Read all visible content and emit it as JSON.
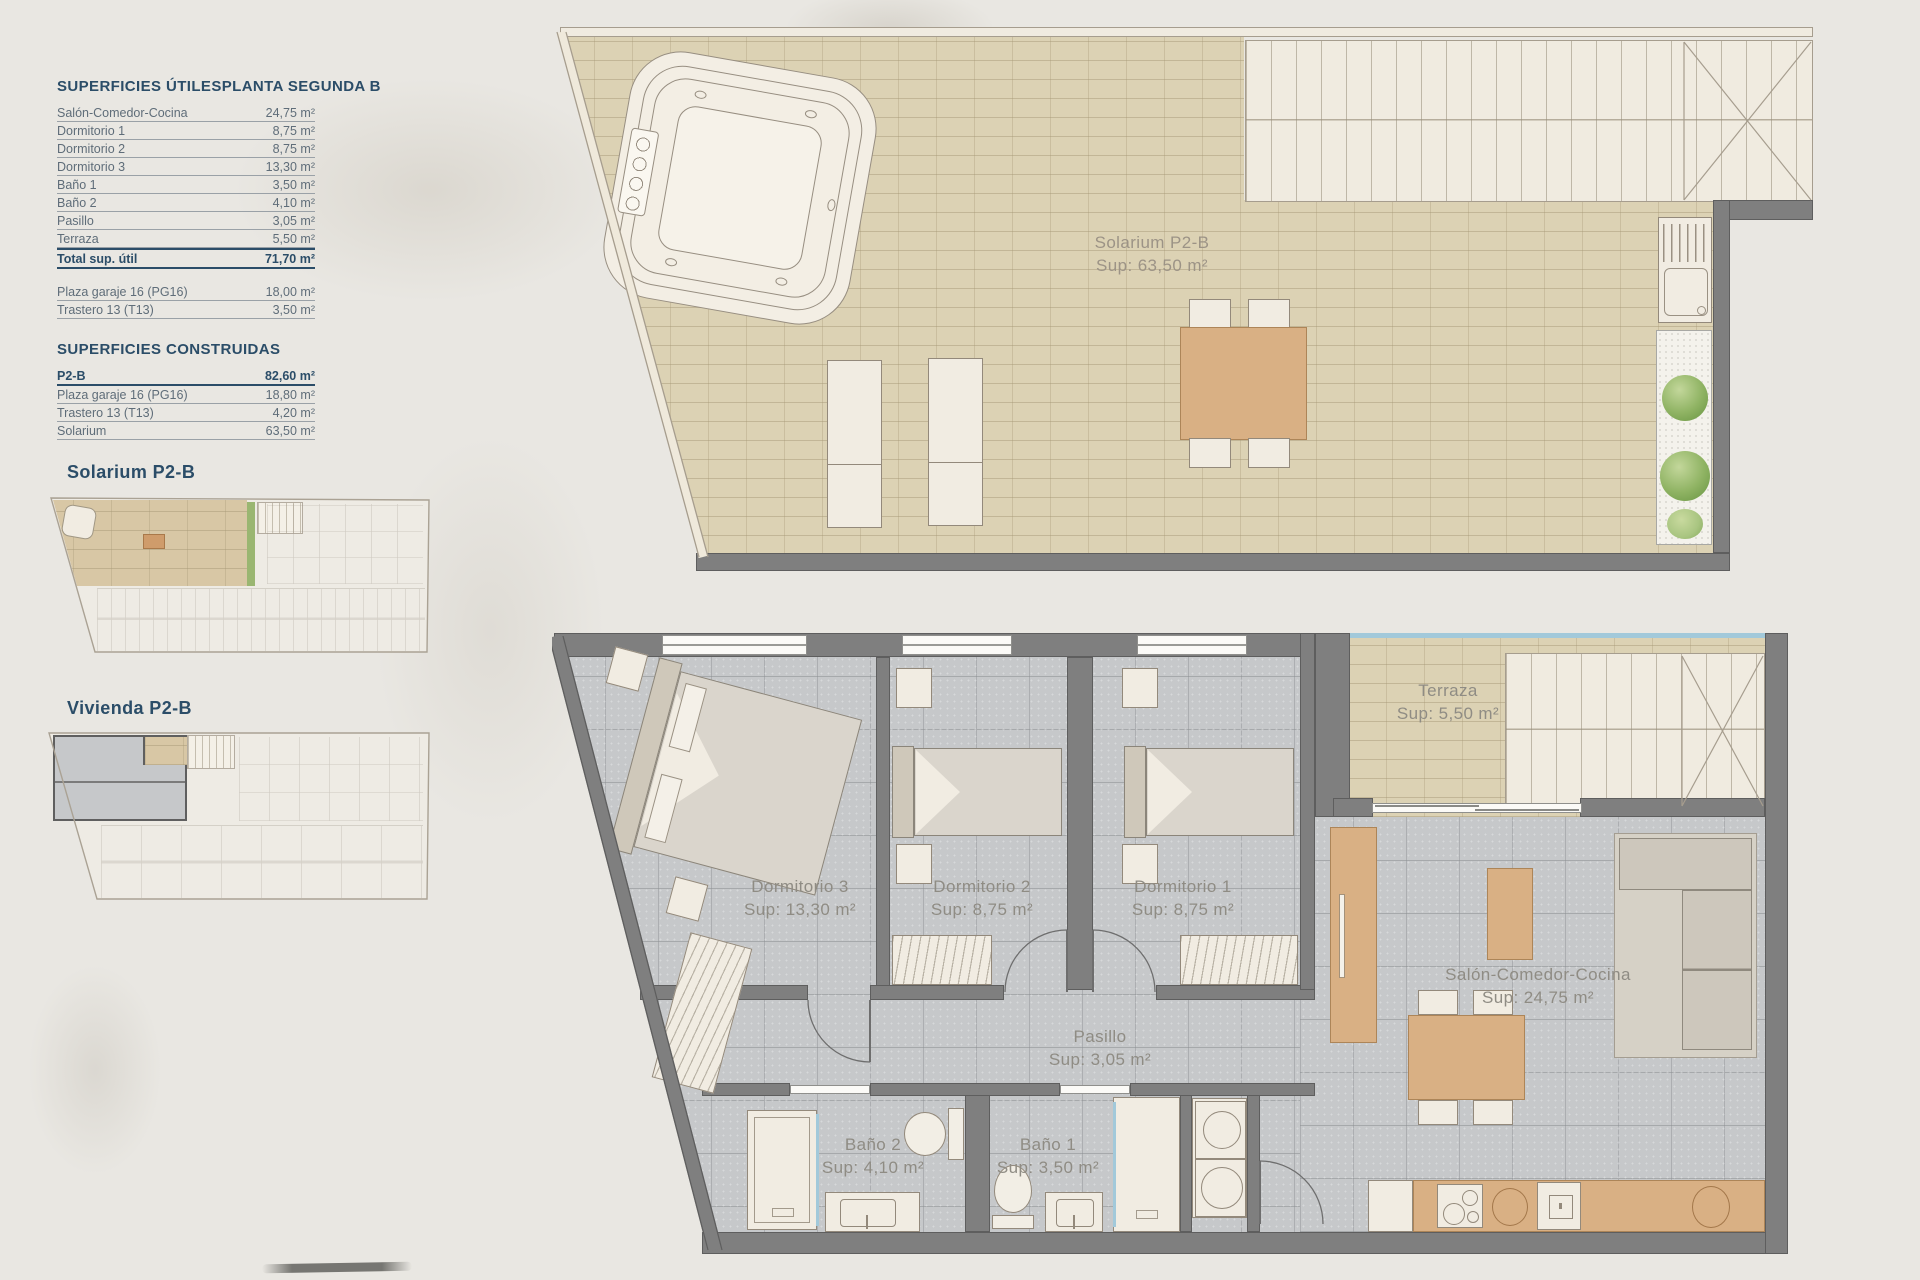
{
  "colors": {
    "heading_navy": "#2b4d68",
    "table_text": "#5f6d79",
    "plan_label_gray": "#8f8c84",
    "wall_gray": "#7f7f7f",
    "beige_tile": "#dcd2b4",
    "gray_tile": "#c6c8ca",
    "wood": "#d9b084",
    "glass_blue": "#a2c9da",
    "plant_green": "#8fb363",
    "highlight_tan": "#d8c7a5"
  },
  "left_panel": {
    "utiles": {
      "title": "SUPERFICIES ÚTILES",
      "subtitle": "PLANTA SEGUNDA B",
      "rows": [
        {
          "label": "Salón-Comedor-Cocina",
          "value": "24,75 m²"
        },
        {
          "label": "Dormitorio 1",
          "value": "8,75 m²"
        },
        {
          "label": "Dormitorio 2",
          "value": "8,75 m²"
        },
        {
          "label": "Dormitorio 3",
          "value": "13,30 m²"
        },
        {
          "label": "Baño 1",
          "value": "3,50 m²"
        },
        {
          "label": "Baño 2",
          "value": "4,10 m²"
        },
        {
          "label": "Pasillo",
          "value": "3,05 m²"
        },
        {
          "label": "Terraza",
          "value": "5,50 m²"
        }
      ],
      "total": {
        "label": "Total sup. útil",
        "value": "71,70 m²"
      },
      "extra": [
        {
          "label": "Plaza garaje 16 (PG16)",
          "value": "18,00 m²"
        },
        {
          "label": "Trastero 13 (T13)",
          "value": "3,50 m²"
        }
      ]
    },
    "construidas": {
      "title": "SUPERFICIES CONSTRUIDAS",
      "rows": [
        {
          "label": "P2-B",
          "value": "82,60 m²"
        },
        {
          "label": "Plaza garaje 16 (PG16)",
          "value": "18,80 m²"
        },
        {
          "label": "Trastero 13 (T13)",
          "value": "4,20 m²"
        },
        {
          "label": "Solarium",
          "value": "63,50 m²"
        }
      ]
    },
    "mini": [
      {
        "label": "Solarium P2-B"
      },
      {
        "label": "Vivienda P2-B"
      }
    ]
  },
  "solarium_plan": {
    "label": "Solarium P2-B",
    "sup": "Sup: 63,50 m²"
  },
  "vivienda_plan": {
    "rooms": [
      {
        "name": "Dormitorio 3",
        "sup": "Sup: 13,30 m²"
      },
      {
        "name": "Dormitorio 2",
        "sup": "Sup: 8,75 m²"
      },
      {
        "name": "Dormitorio 1",
        "sup": "Sup: 8,75 m²"
      },
      {
        "name": "Terraza",
        "sup": "Sup: 5,50 m²"
      },
      {
        "name": "Pasillo",
        "sup": "Sup: 3,05 m²"
      },
      {
        "name": "Baño 2",
        "sup": "Sup: 4,10 m²"
      },
      {
        "name": "Baño 1",
        "sup": "Sup: 3,50 m²"
      },
      {
        "name": "Salón-Comedor-Cocina",
        "sup": "Sup: 24,75 m²"
      }
    ]
  }
}
